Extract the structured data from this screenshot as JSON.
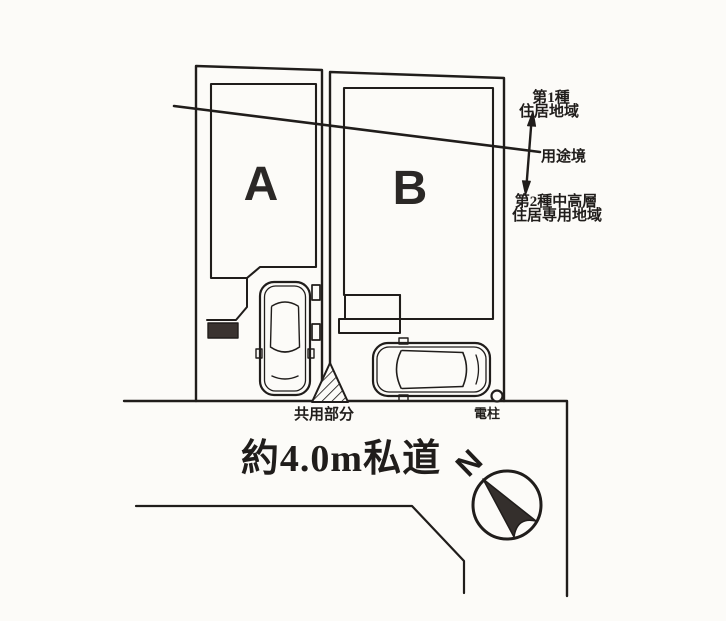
{
  "colors": {
    "ink": "#201d1b",
    "dark_fill": "#3a3330",
    "paper": "#fcfbf8"
  },
  "plan": {
    "lots": [
      {
        "label": "A"
      },
      {
        "label": "B"
      }
    ],
    "zoning": {
      "zone1": {
        "line1": "第1種",
        "line2": "住居地域"
      },
      "boundary_label": "用途境",
      "zone2": {
        "line1": "第2種中高層",
        "line2": "住居専用地域"
      }
    },
    "shared_area_label": "共用部分",
    "utility_pole_label": "電柱",
    "road_label": "約4.0m私道",
    "compass": {
      "north_label": "N"
    }
  }
}
